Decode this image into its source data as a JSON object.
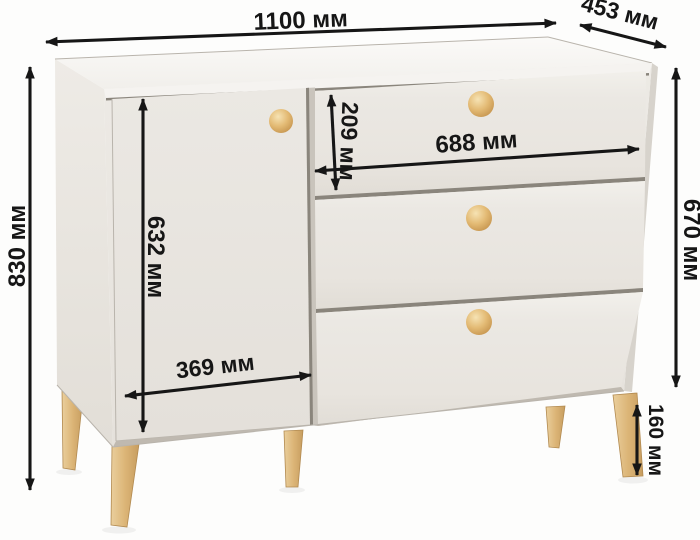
{
  "title": "Схема размеров комода",
  "unit": "мм",
  "dimensions": {
    "width": "1100 мм",
    "depth": "453 мм",
    "height": "830 мм",
    "body_height": "670 мм",
    "leg_height": "160 мм",
    "drawer_height": "209 мм",
    "drawer_width": "688 мм",
    "door_height": "632 мм",
    "door_width": "369 мм"
  },
  "colors": {
    "body": "#e9e6e1",
    "top": "#f8f7f4",
    "wood_legs": "#ddb87e",
    "wood_knobs": "#e2bb77",
    "dimension_lines": "#161616",
    "background": "#fdfdfc"
  },
  "parts": {
    "door_count": 1,
    "drawer_count": 3,
    "visible_legs": 5,
    "knob_count": 4
  }
}
